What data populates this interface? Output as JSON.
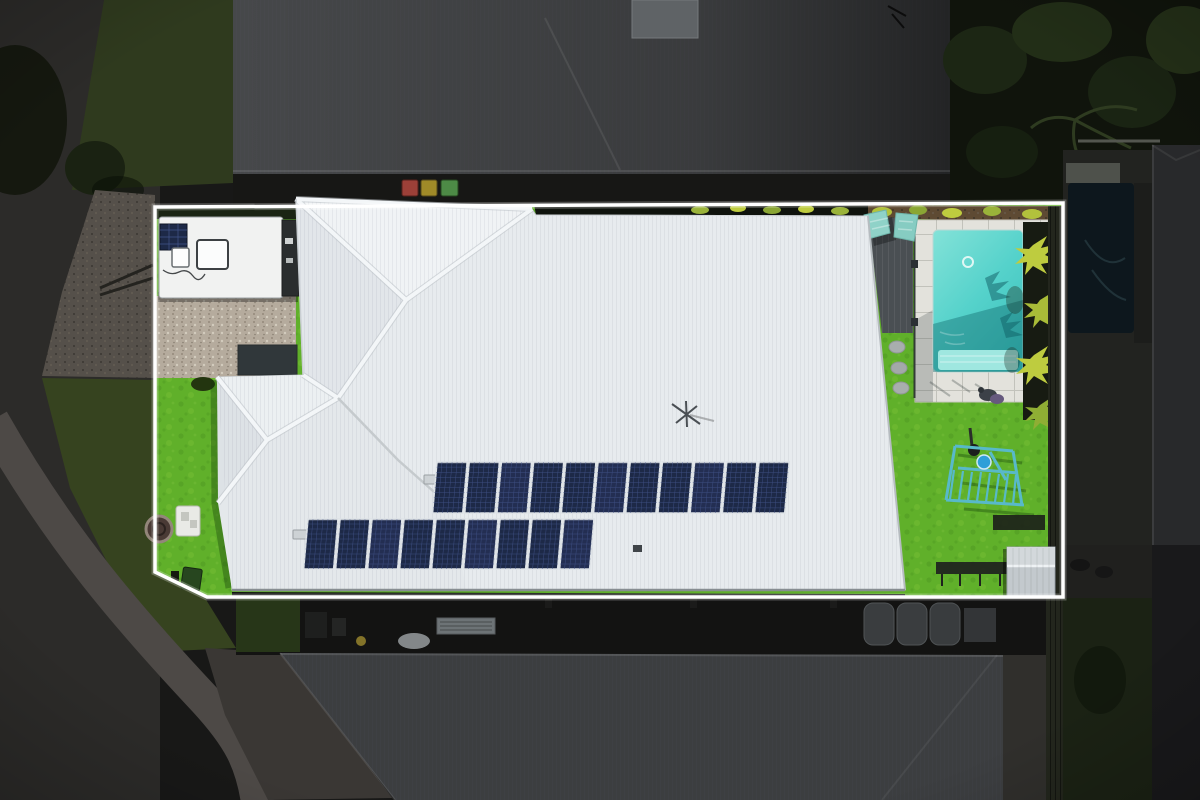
{
  "scene": {
    "type": "aerial-drone-photo",
    "subject": "residential-property-with-highlighted-lot-boundary",
    "highlight_style": "white-outline-surroundings-dimmed",
    "palette": {
      "boundary": "#ffffff",
      "roof_white": "#e7ebee",
      "ridge_light": "#f3f6f8",
      "pool_water": "#55d2cb",
      "pool_paving": "#e3e2dc",
      "pool_steps": "#9fe7e0",
      "deck": "#4a4f53",
      "lawn_bright": "#60b02a",
      "lawn_dim": "#36431f",
      "gravel_bright": "#b5ab9d",
      "gravel_dim": "#55504a",
      "road": "#2c2b29",
      "footpath": "#4d4946",
      "panel": "#1d2947",
      "panel_cell": "#42548a",
      "panel_frame": "#dde2e6",
      "caravan": "#f1f2f1",
      "neighbor_roof_top": "#46484a",
      "neighbor_roof_bottom": "#3c3e40",
      "foliage_dark": "#10140c",
      "hedge": "#0f130d",
      "mulch": "#5e4a33",
      "shed": "#c3c9cd",
      "play_frame": "#58b9c9",
      "plant_leaf": "#becc3f",
      "fence_dark": "#23261d",
      "patio_dark": "#131312"
    },
    "counts": {
      "roof_solar_rows": 2,
      "solar_panels_row_upper": 11,
      "solar_panels_row_lower": 9,
      "caravan_solar_panels": 1,
      "wheelie_bins_top": 3,
      "wheelie_bins_bottom": 3,
      "stepping_stones": 3
    },
    "solar": {
      "rows": [
        {
          "panels": 11
        },
        {
          "panels": 9
        }
      ]
    },
    "bins": {
      "colors": [
        "#9c4038",
        "#a08a28",
        "#4d8a46"
      ]
    },
    "objects": [
      "main-house-white-roof",
      "rooftop-solar-array",
      "caravan",
      "gravel-driveway",
      "swimming-pool",
      "pool-deck",
      "sun-loungers",
      "garden-shed",
      "play-frame",
      "lawn",
      "neighbor-houses",
      "street",
      "footpath",
      "palm-trees",
      "neighbor-pool"
    ]
  }
}
